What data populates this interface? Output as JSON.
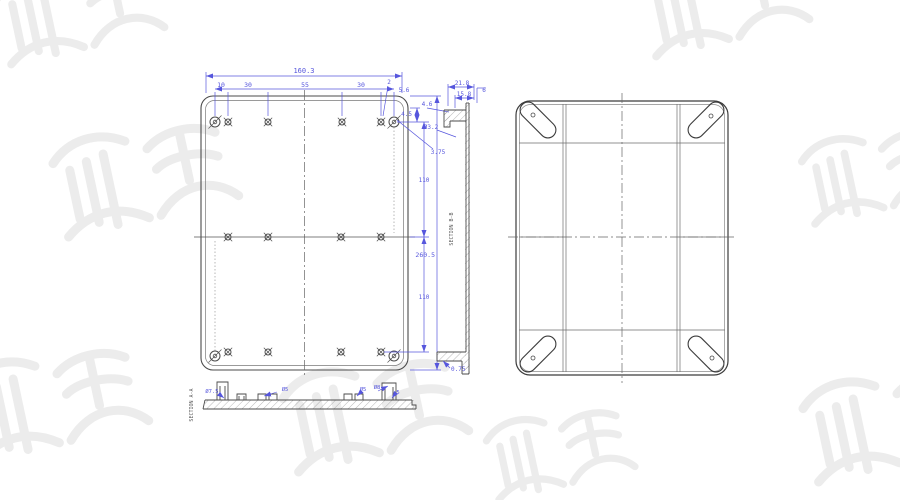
{
  "colors": {
    "line": "#4b4b4b",
    "dimension": "#5656dd",
    "watermark": "#ececec",
    "background": "#ffffff"
  },
  "front_view": {
    "overall_width": "160.3",
    "top_dims": [
      "10",
      "30",
      "55",
      "30"
    ],
    "callout_2": "2",
    "callout_5_6": "5.6",
    "callout_4_5": "4.5",
    "callout_4_6": "4.6",
    "callout_3_2": "Ø3.2",
    "callout_3_75": "3.75",
    "height_upper": "110",
    "height_overall": "260.5",
    "height_lower": "110"
  },
  "side_section": {
    "title": "SECTION B-B",
    "dim_21_8": "21.8",
    "dim_15_8": "15.8",
    "dim_6": "6",
    "dim_0_75": "0.75"
  },
  "bottom_section": {
    "title": "SECTION A-A",
    "dim_d7_5": "Ø7.5",
    "dim_d5_left": "Ø5",
    "dim_d5_right": "Ø5",
    "dim_d8": "Ø8",
    "dim_5": "5"
  }
}
